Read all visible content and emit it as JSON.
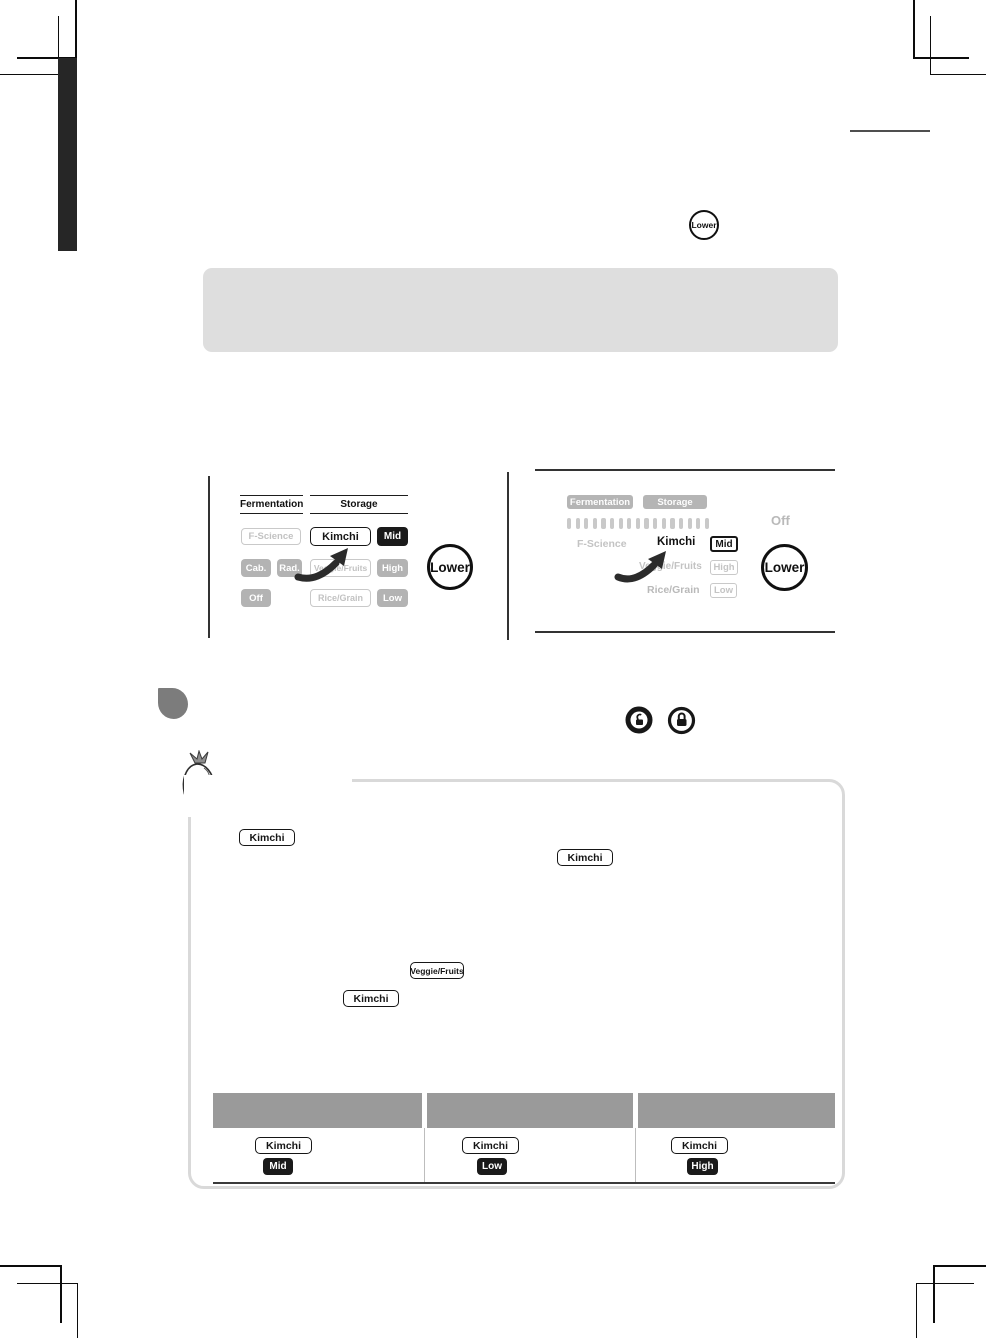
{
  "top": {
    "lower_button": "Lower"
  },
  "panel_left": {
    "header_fermentation": "Fermentation",
    "header_storage": "Storage",
    "f_science": "F-Science",
    "kimchi": "Kimchi",
    "mid": "Mid",
    "cab": "Cab.",
    "rad": "Rad.",
    "veggie_fruits": "Veggie/Fruits",
    "high": "High",
    "off": "Off",
    "rice_grain": "Rice/Grain",
    "low": "Low",
    "lower_button": "Lower"
  },
  "panel_right": {
    "fermentation": "Fermentation",
    "storage": "Storage",
    "off": "Off",
    "f_science": "F-Science",
    "kimchi": "Kimchi",
    "mid": "Mid",
    "veggie_fruits": "Veggie/Fruits",
    "high": "High",
    "rice_grain": "Rice/Grain",
    "low": "Low",
    "segment_count": 17,
    "lower_button": "Lower"
  },
  "icons": {
    "unlock": "unlock-icon",
    "lock": "lock-icon",
    "mascot": "radish-mascot"
  },
  "content_box": {
    "kimchi_1": "Kimchi",
    "kimchi_2": "Kimchi",
    "veggie_fruits": "Veggie/Fruits",
    "kimchi_3": "Kimchi"
  },
  "table": {
    "columns": [
      {
        "button": "Kimchi",
        "level": "Mid"
      },
      {
        "button": "Kimchi",
        "level": "Low"
      },
      {
        "button": "Kimchi",
        "level": "High"
      }
    ]
  },
  "colors": {
    "black": "#1a1a1a",
    "button_gray": "#b3b3b3",
    "light_gray_text": "#c2c2c2",
    "table_header_gray": "#9a9a9a",
    "box_border_gray": "#d9d9d9",
    "note_box_gray": "#dedede",
    "section_blob_gray": "#7c7c7c"
  }
}
